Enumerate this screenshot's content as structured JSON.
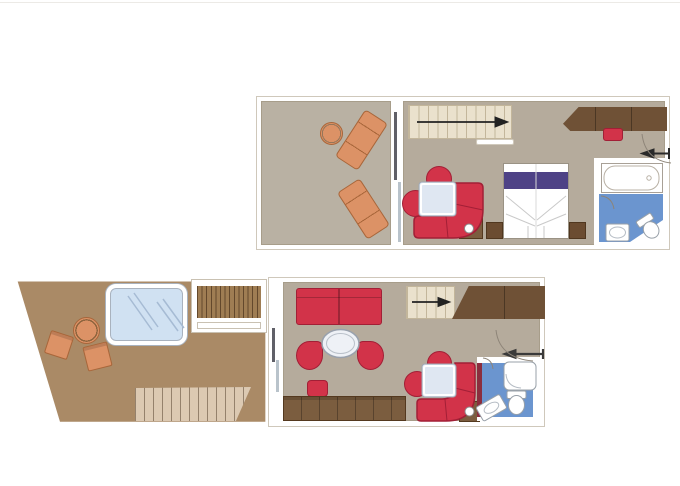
{
  "meta": {
    "title": "Two-level duplex suite floor plan",
    "type": "floor-plan",
    "levels": 2
  },
  "palette": {
    "background": "#ffffff",
    "wall": "#ffffff",
    "wall_outline": "#cfc8bb",
    "floor_edge": "#a79d8a",
    "balcony_floor": "#b9b1a3",
    "interior_floor": "#b5ab9c",
    "terrace_floor": "#aa8a66",
    "wood_dark": "#6f5136",
    "wood_mid": "#7b5d3f",
    "wood_slat": "#9f7d53",
    "deck_light": "#dcc9b2",
    "stair_tread": "#eae1cd",
    "stair_line": "#c3b69b",
    "furniture_red": "#d23349",
    "furniture_red_dark": "#a21f36",
    "lounger_orange": "#dc9266",
    "lounger_orange_dark": "#a8663a",
    "pool_blue": "#d0e1f2",
    "bath_blue": "#6b95cf",
    "bed_purple": "#4e4286",
    "table_light": "#dfe7f2",
    "sanitary_stroke": "#98a0a8",
    "arrow_dark": "#222222",
    "accent_maroon": "#8b2e3e"
  },
  "upper_level": {
    "label": "Upper level",
    "balcony": {
      "name": "balcony",
      "furniture": [
        "sun-lounger",
        "sun-lounger",
        "round-side-table"
      ],
      "divider": "sliding-glass-door"
    },
    "bedroom": {
      "name": "bedroom",
      "furniture": [
        "staircase",
        "double-bed-with-purple-runner",
        "nightstand",
        "nightstand",
        "curved-sofa",
        "round-chair",
        "round-chair",
        "square-side-table",
        "media-cabinet",
        "wardrobe",
        "stool"
      ]
    },
    "bathroom": {
      "name": "bathroom",
      "fixtures": [
        "bathtub",
        "washbasin",
        "toilet"
      ],
      "door": "quarter-arc"
    },
    "stairs_arrow_direction": "right",
    "entry": {
      "door_swing": "quarter-arc",
      "arrow_direction": "left"
    }
  },
  "lower_level": {
    "label": "Main level",
    "terrace": {
      "name": "terrace",
      "furniture": [
        "whirlpool-hot-tub",
        "deck-stairs",
        "round-table",
        "deck-chair",
        "deck-chair",
        "wide-deck-steps"
      ]
    },
    "living_room": {
      "name": "living-room",
      "furniture": [
        "sofa",
        "oval-coffee-table",
        "tub-chair",
        "tub-chair",
        "stool",
        "desk-sideboard",
        "staircase",
        "wardrobe",
        "curved-sofa",
        "round-chair",
        "round-chair",
        "square-side-table",
        "media-cabinet"
      ],
      "divider": "sliding-glass-door"
    },
    "bathroom": {
      "name": "bathroom",
      "fixtures": [
        "shower",
        "toilet",
        "washbasin"
      ],
      "door": "quarter-arc"
    },
    "stairs_arrow_direction": "right",
    "entry": {
      "door_swing": "quarter-arc",
      "arrow_direction": "left"
    }
  }
}
